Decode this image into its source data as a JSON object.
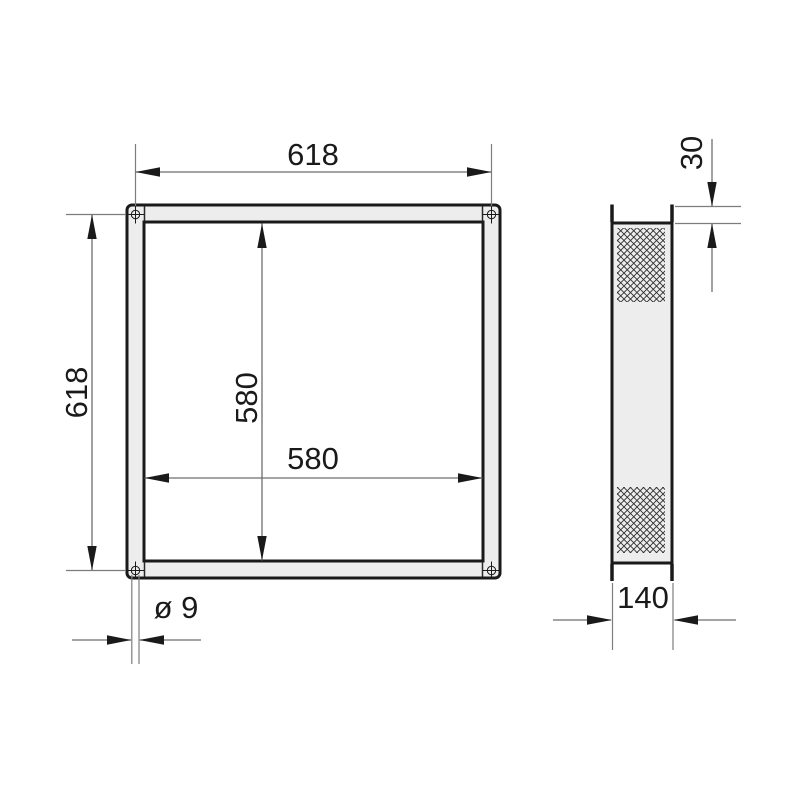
{
  "drawing": {
    "type": "technical-dimension-drawing",
    "colors": {
      "background": "#ffffff",
      "part_fill": "#ededed",
      "outline": "#1a1a1a",
      "dimension_line": "#6e6e6e"
    },
    "front_view": {
      "outer_width_label": "618",
      "outer_height_label": "618",
      "inner_width_label": "580",
      "inner_height_label": "580",
      "hole_diameter_label": "ø 9"
    },
    "side_view": {
      "flange_offset_label": "30",
      "depth_label": "140"
    }
  }
}
